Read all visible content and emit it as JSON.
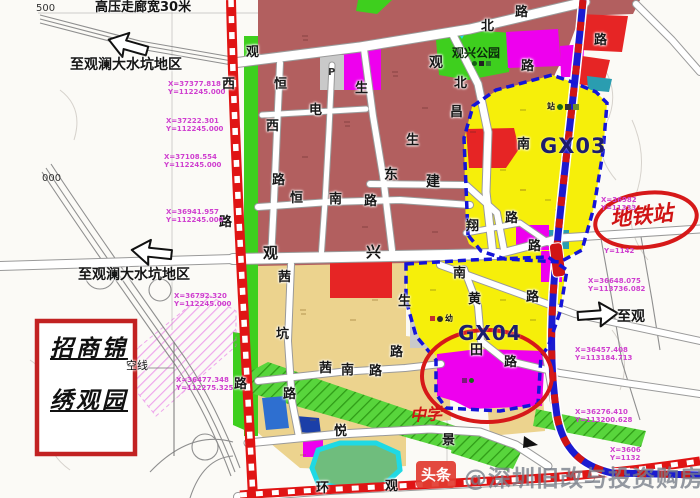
{
  "map": {
    "corridor_label": "高压走廊宽30米",
    "grid_500": "500",
    "grid_000": "000",
    "directions": {
      "top": "至观澜大水坑地区",
      "mid": "至观澜大水坑地区",
      "right": "至观"
    },
    "zones": {
      "park_label": "观兴公园",
      "gx03_label": "GX03",
      "gx04_label": "GX04",
      "school_label": "中学",
      "parking_label": "P",
      "station_cluster_label": "站",
      "kindergarten_cluster_label": "幼"
    },
    "metro_station_label": "地铁站",
    "project_box": {
      "line1": "招商锦",
      "line2": "绣观园"
    },
    "overhead_line_label": "空线",
    "watermark": {
      "logo": "头条",
      "text": "@深圳旧改与投资购房"
    },
    "road_chars": [
      {
        "t": "观",
        "x": 246,
        "y": 46
      },
      {
        "t": "恒",
        "x": 274,
        "y": 78
      },
      {
        "t": "西",
        "x": 266,
        "y": 120
      },
      {
        "t": "路",
        "x": 272,
        "y": 174
      },
      {
        "t": "观",
        "x": 263,
        "y": 246,
        "s": 15
      },
      {
        "t": "兴",
        "x": 366,
        "y": 245,
        "s": 15
      },
      {
        "t": "西",
        "x": 222,
        "y": 78
      },
      {
        "t": "路",
        "x": 219,
        "y": 216
      },
      {
        "t": "路",
        "x": 234,
        "y": 378
      },
      {
        "t": "电",
        "x": 309,
        "y": 104
      },
      {
        "t": "生",
        "x": 355,
        "y": 82
      },
      {
        "t": "生",
        "x": 406,
        "y": 134
      },
      {
        "t": "生",
        "x": 398,
        "y": 295
      },
      {
        "t": "东",
        "x": 384,
        "y": 168,
        "s": 14
      },
      {
        "t": "建",
        "x": 426,
        "y": 175,
        "s": 14
      },
      {
        "t": "观",
        "x": 429,
        "y": 56,
        "s": 14
      },
      {
        "t": "北",
        "x": 454,
        "y": 77
      },
      {
        "t": "北",
        "x": 481,
        "y": 20
      },
      {
        "t": "路",
        "x": 515,
        "y": 6
      },
      {
        "t": "路",
        "x": 521,
        "y": 60
      },
      {
        "t": "路",
        "x": 594,
        "y": 34
      },
      {
        "t": "昌",
        "x": 450,
        "y": 106
      },
      {
        "t": "南",
        "x": 517,
        "y": 138
      },
      {
        "t": "翔",
        "x": 466,
        "y": 220
      },
      {
        "t": "路",
        "x": 505,
        "y": 212
      },
      {
        "t": "路",
        "x": 528,
        "y": 240
      },
      {
        "t": "南",
        "x": 453,
        "y": 267
      },
      {
        "t": "路",
        "x": 526,
        "y": 291
      },
      {
        "t": "黄",
        "x": 468,
        "y": 293
      },
      {
        "t": "田",
        "x": 470,
        "y": 344
      },
      {
        "t": "路",
        "x": 504,
        "y": 356
      },
      {
        "t": "茜",
        "x": 278,
        "y": 271
      },
      {
        "t": "坑",
        "x": 276,
        "y": 328
      },
      {
        "t": "路",
        "x": 283,
        "y": 388
      },
      {
        "t": "茜",
        "x": 319,
        "y": 362
      },
      {
        "t": "南",
        "x": 341,
        "y": 364
      },
      {
        "t": "路",
        "x": 369,
        "y": 365
      },
      {
        "t": "悦",
        "x": 334,
        "y": 425
      },
      {
        "t": "环",
        "x": 316,
        "y": 482
      },
      {
        "t": "观",
        "x": 385,
        "y": 480
      },
      {
        "t": "景",
        "x": 442,
        "y": 434
      },
      {
        "t": "恒",
        "x": 290,
        "y": 192
      },
      {
        "t": "南",
        "x": 329,
        "y": 193
      },
      {
        "t": "路",
        "x": 364,
        "y": 195
      },
      {
        "t": "路",
        "x": 390,
        "y": 346
      }
    ],
    "coords": [
      {
        "l1": "X=37377.818",
        "l2": "Y=112245.000",
        "x": 168,
        "y": 80
      },
      {
        "l1": "X=37222.301",
        "l2": "Y=112245.000",
        "x": 166,
        "y": 117
      },
      {
        "l1": "X=37108.554",
        "l2": "Y=112245.000",
        "x": 164,
        "y": 153
      },
      {
        "l1": "X=36941.957",
        "l2": "Y=112245.000",
        "x": 166,
        "y": 208
      },
      {
        "l1": "X=36792.320",
        "l2": "Y=112245.000",
        "x": 174,
        "y": 292
      },
      {
        "l1": "X=36477.348",
        "l2": "Y=112275.325",
        "x": 176,
        "y": 376
      },
      {
        "l1": "X=36982",
        "l2": "Y=11333",
        "x": 601,
        "y": 196
      },
      {
        "l1": "Y=1142",
        "l2": "",
        "x": 604,
        "y": 247
      },
      {
        "l1": "X=36648.075",
        "l2": "Y=113736.082",
        "x": 588,
        "y": 277
      },
      {
        "l1": "X=36457.408",
        "l2": "Y=113184.713",
        "x": 575,
        "y": 346
      },
      {
        "l1": "X=36276.410",
        "l2": "Y=113200.628",
        "x": 575,
        "y": 408
      },
      {
        "l1": "X=3606",
        "l2": "Y=1132",
        "x": 610,
        "y": 446
      }
    ],
    "palette": {
      "dark_red_zone": "#b25f5f",
      "red_zone": "#e62525",
      "magenta_zone": "#ee00ee",
      "yellow_zone": "#f6ef0a",
      "tan_zone": "#ecd38e",
      "green_zone": "#3ecf1e",
      "pond_water": "#1fd9e4",
      "gray_zone": "#c9c9c9",
      "blue_zone": "#2e6fd0",
      "metro_blue": "#1b1bd0",
      "metro_red": "#d01515",
      "boundary_blue": "#1414d8",
      "boundary_road_red": "#e01414",
      "annotation_red": "#d61919",
      "coord_pink": "#cf3fcf",
      "gx_label": "#1c1c6e",
      "watermark_red": "#e23b30"
    }
  }
}
